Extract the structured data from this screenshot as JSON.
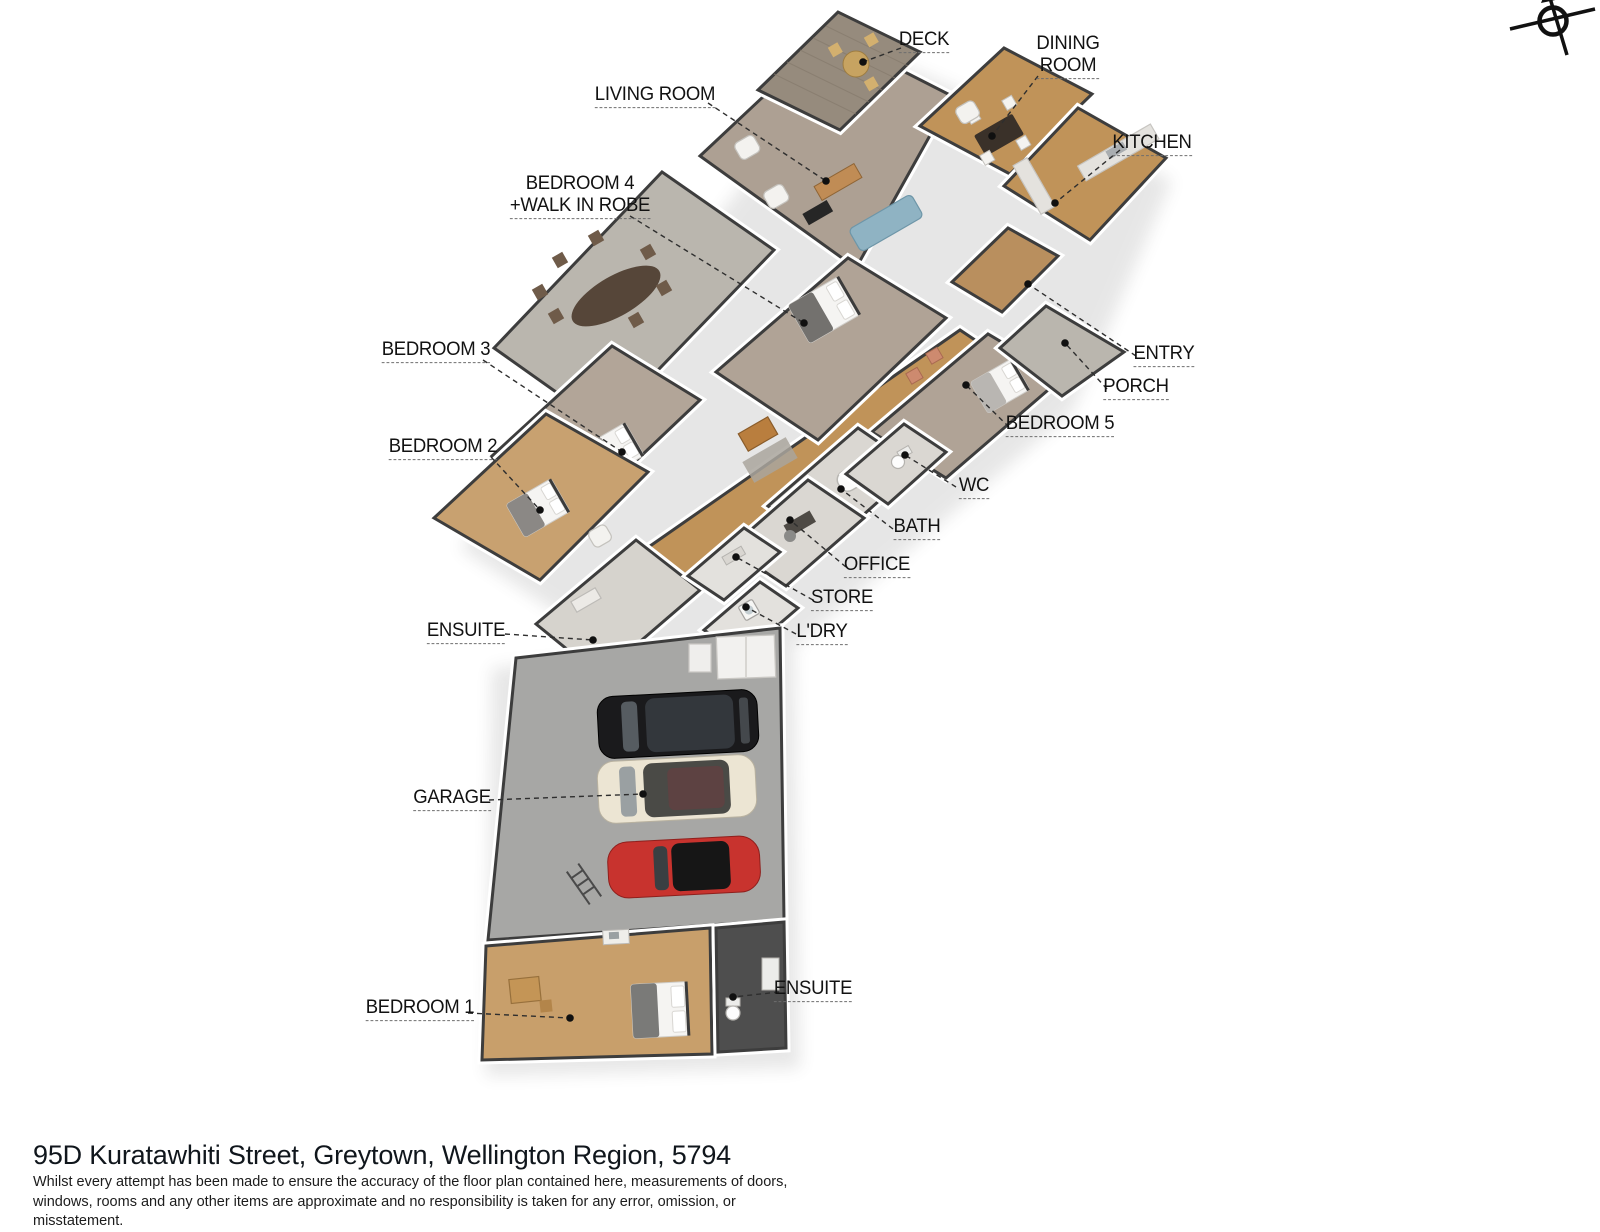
{
  "footer": {
    "address_title": "95D Kuratawhiti Street, Greytown, Wellington Region, 5794",
    "disclaimer": "Whilst every attempt has been made to ensure the accuracy of the floor plan contained here, measurements of doors, windows, rooms and any other items are approximate and no responsibility is taken for any error, omission, or misstatement."
  },
  "compass": {
    "icon": "compass-north-icon"
  },
  "palette": {
    "wall_outline": "#3d3d3d",
    "wood_floor": "#c09359",
    "wood_floor_light": "#c8a170",
    "carpet_taupe": "#ada093",
    "concrete": "#bab6ae",
    "deck_wood": "#968b7d",
    "garage_floor": "#a7a7a5",
    "dark_tile": "#4e4e4e",
    "sofa_blue": "#8fb3c3",
    "chair_salmon": "#cd8a6f",
    "suv_black": "#1a1a1c",
    "van_cream": "#ece5d3",
    "sportscar_red": "#c8332e",
    "label_text": "#121212"
  },
  "labels": [
    {
      "id": "deck",
      "lines": [
        "DECK"
      ],
      "x": 924,
      "y": 41,
      "ax": 901,
      "ay": 48,
      "dx": 863,
      "dy": 62
    },
    {
      "id": "dining-room",
      "lines": [
        "DINING",
        "ROOM"
      ],
      "x": 1068,
      "y": 56,
      "ax": 1038,
      "ay": 76,
      "dx": 992,
      "dy": 136
    },
    {
      "id": "living-room",
      "lines": [
        "LIVING ROOM"
      ],
      "x": 655,
      "y": 96,
      "ax": 708,
      "ay": 103,
      "dx": 826,
      "dy": 181
    },
    {
      "id": "bedroom-4-walk-in-robe",
      "lines": [
        "BEDROOM 4",
        "+WALK IN ROBE"
      ],
      "x": 580,
      "y": 196,
      "ax": 630,
      "ay": 216,
      "dx": 804,
      "dy": 323
    },
    {
      "id": "kitchen",
      "lines": [
        "KITCHEN"
      ],
      "x": 1152,
      "y": 144,
      "ax": 1120,
      "ay": 150,
      "dx": 1055,
      "dy": 203
    },
    {
      "id": "entry",
      "lines": [
        "ENTRY"
      ],
      "x": 1164,
      "y": 355,
      "ax": 1136,
      "ay": 356,
      "dx": 1028,
      "dy": 284
    },
    {
      "id": "porch",
      "lines": [
        "PORCH"
      ],
      "x": 1136,
      "y": 388,
      "ax": 1107,
      "ay": 389,
      "dx": 1065,
      "dy": 343
    },
    {
      "id": "bedroom-5",
      "lines": [
        "BEDROOM 5"
      ],
      "x": 1060,
      "y": 425,
      "ax": 1009,
      "ay": 427,
      "dx": 966,
      "dy": 385
    },
    {
      "id": "bedroom-3",
      "lines": [
        "BEDROOM 3"
      ],
      "x": 436,
      "y": 351,
      "ax": 483,
      "ay": 360,
      "dx": 622,
      "dy": 452
    },
    {
      "id": "bedroom-2",
      "lines": [
        "BEDROOM 2"
      ],
      "x": 443,
      "y": 448,
      "ax": 491,
      "ay": 457,
      "dx": 540,
      "dy": 510
    },
    {
      "id": "wc",
      "lines": [
        "WC"
      ],
      "x": 974,
      "y": 487,
      "ax": 956,
      "ay": 487,
      "dx": 905,
      "dy": 455
    },
    {
      "id": "bath",
      "lines": [
        "BATH"
      ],
      "x": 917,
      "y": 528,
      "ax": 893,
      "ay": 529,
      "dx": 841,
      "dy": 489
    },
    {
      "id": "office",
      "lines": [
        "OFFICE"
      ],
      "x": 877,
      "y": 566,
      "ax": 846,
      "ay": 567,
      "dx": 790,
      "dy": 520
    },
    {
      "id": "store",
      "lines": [
        "STORE"
      ],
      "x": 842,
      "y": 599,
      "ax": 813,
      "ay": 600,
      "dx": 736,
      "dy": 557
    },
    {
      "id": "laundry",
      "lines": [
        "L'DRY"
      ],
      "x": 822,
      "y": 633,
      "ax": 796,
      "ay": 634,
      "dx": 746,
      "dy": 607
    },
    {
      "id": "ensuite-upper",
      "lines": [
        "ENSUITE"
      ],
      "x": 466,
      "y": 632,
      "ax": 505,
      "ay": 634,
      "dx": 593,
      "dy": 640
    },
    {
      "id": "garage",
      "lines": [
        "GARAGE"
      ],
      "x": 452,
      "y": 799,
      "ax": 489,
      "ay": 800,
      "dx": 643,
      "dy": 794
    },
    {
      "id": "bedroom-1",
      "lines": [
        "BEDROOM 1"
      ],
      "x": 420,
      "y": 1009,
      "ax": 468,
      "ay": 1013,
      "dx": 570,
      "dy": 1018
    },
    {
      "id": "ensuite-lower",
      "lines": [
        "ENSUITE"
      ],
      "x": 813,
      "y": 990,
      "ax": 779,
      "ay": 992,
      "dx": 733,
      "dy": 997
    }
  ]
}
